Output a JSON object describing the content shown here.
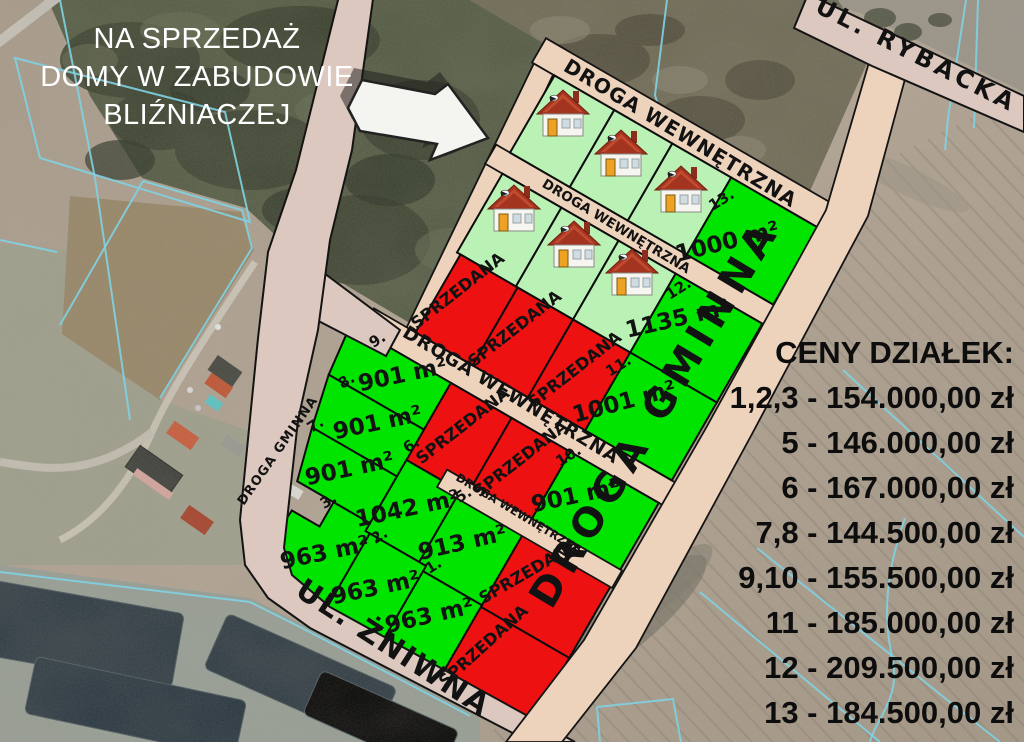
{
  "map": {
    "title_overlay": {
      "lines": [
        "NA SPRZEDAŻ",
        "DOMY W ZABUDOWIE",
        "BLIŹNIACZEJ"
      ]
    },
    "price_list": {
      "heading": "CENY DZIAŁEK:",
      "items": [
        "1,2,3 - 154.000,00 zł",
        "5 - 146.000,00 zł",
        "6 - 167.000,00 zł",
        "7,8 - 144.500,00 zł",
        "9,10 - 155.500,00 zł",
        "11 - 185.000,00 zł",
        "12 - 209.500,00 zł",
        "13 - 184.500,00 zł"
      ]
    },
    "streets": {
      "rybacka": "UL. RYBACKA",
      "gminna": "DROGA GMINNA",
      "gminna_left": "DROGA GMINNA",
      "zniwna": "UL. ŻNIWNA",
      "internal_road": "DROGA WEWNĘTRZNA"
    },
    "labels": {
      "sold": "SPRZEDANA"
    },
    "plots": {
      "p1": {
        "number": "1.",
        "area": "963 m²"
      },
      "p2": {
        "number": "2.",
        "area": "963 m²"
      },
      "p3": {
        "number": "3.",
        "area": "963 m²"
      },
      "p5": {
        "number": "5.",
        "area": "913 m²"
      },
      "p6": {
        "number": "6.",
        "area": "1042 m²"
      },
      "p7": {
        "number": "7.",
        "area": "901 m²"
      },
      "p8": {
        "number": "8.",
        "area": "901 m²"
      },
      "p9": {
        "number": "9.",
        "area": "901 m²"
      },
      "p10": {
        "number": "10.",
        "area": "901 m²"
      },
      "p11": {
        "number": "11.",
        "area": "1001 m²"
      },
      "p12": {
        "number": "12.",
        "area": "1135 m²"
      },
      "p13": {
        "number": "13.",
        "area": "1000 m²"
      }
    },
    "sold_plots_count": 7,
    "house_icons_count": 6,
    "colors": {
      "available_green": "#00e400",
      "house_plot_green": "#b9f2b4",
      "sold_red": "#ee1111",
      "dev_road_fill": "#eed3bc",
      "outer_road_fill": "#dcc8bf",
      "cadastral_cyan": "#7fd2e2",
      "label_black": "#121212",
      "title_white": "#ffffff"
    }
  }
}
